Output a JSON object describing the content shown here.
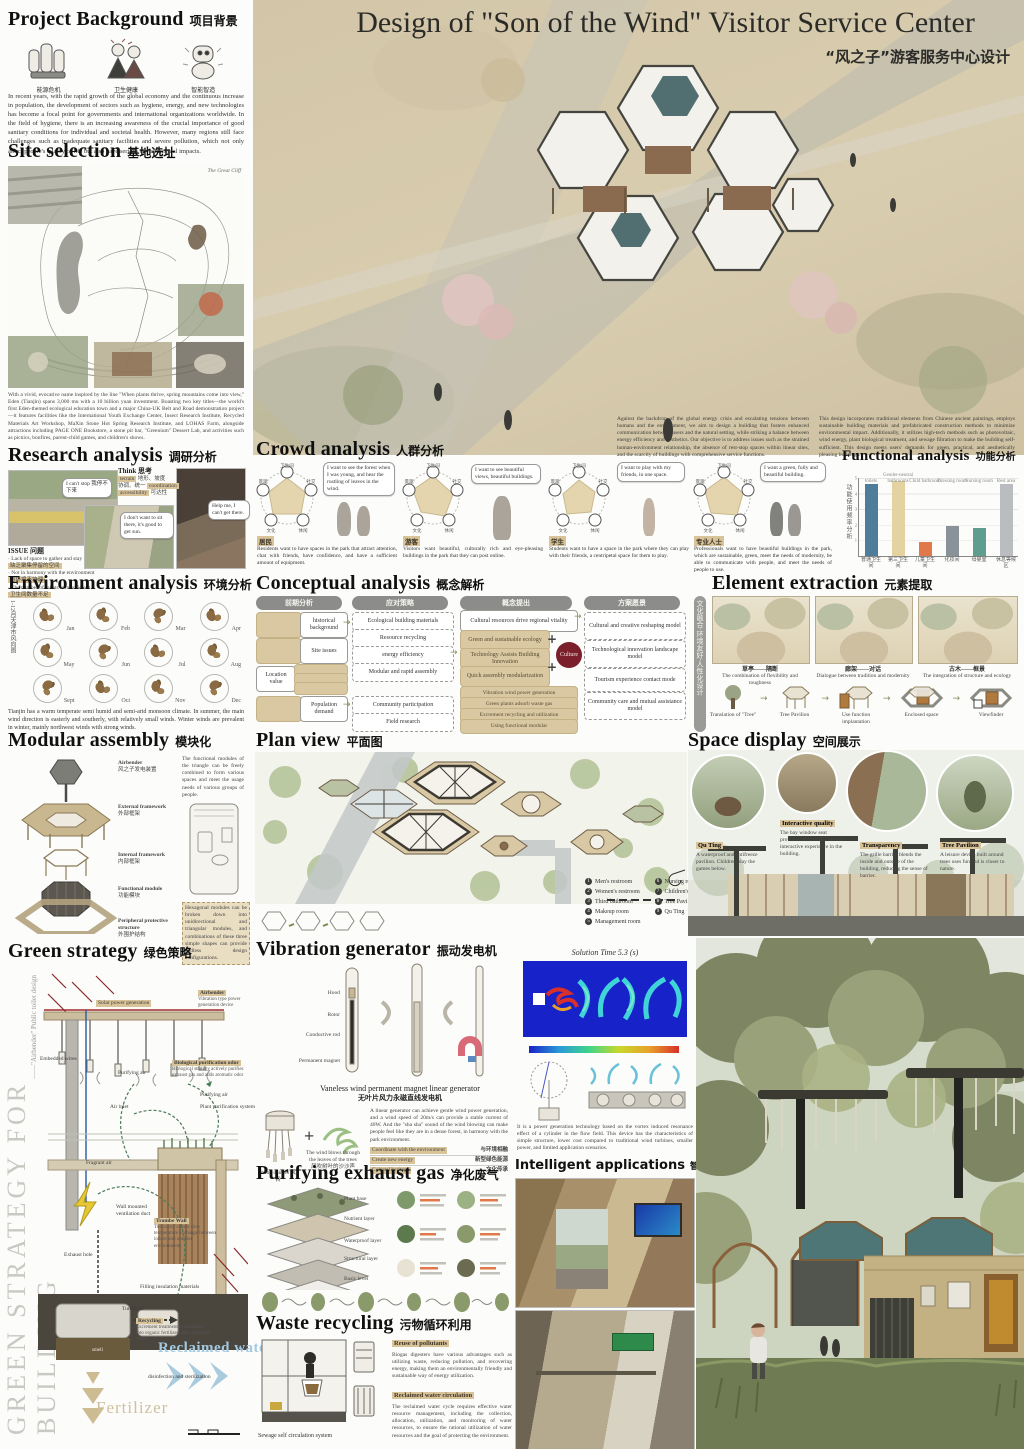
{
  "ui": {
    "plus": "+",
    "arrow": "→",
    "think_arrow": "➤"
  },
  "poster": {
    "title_en": "Design of \"Son of the Wind\" Visitor Service Center",
    "title_zh": "“风之子”游客服务中心设计"
  },
  "background": {
    "h_en": "Project Background",
    "h_zh": "项目背景",
    "icons": [
      {
        "label": "能源危机"
      },
      {
        "label": "卫生健康"
      },
      {
        "label": "智能智造"
      }
    ],
    "body": "In recent years, with the rapid growth of the global economy and the continuous increase in population, the development of sectors such as hygiene, energy, and new technologies has become a focal point for governments and international organizations worldwide. In the field of hygiene, there is an increasing awareness of the crucial importance of good sanitary conditions for individual and societal health. However, many regions still face challenges such as inadequate sanitary facilities and severe pollution, which not only affect people's quality of life but also have serious environmental impacts."
  },
  "site": {
    "h_en": "Site selection",
    "h_zh": "基地选址",
    "map_label": "The Great Cliff",
    "body": "With a vivid, evocative name inspired by the line \"When plants thrive, spring mountains come into view,\" Eden (Tianjin) spans 3,000 mu with a 10 billion yuan investment. Boasting two key titles—the world's first Eden-themed ecological education town and a major China-UK Belt and Road demonstration project—it features facilities like the International Youth Exchange Center, Insect Research Institute, Recycled Materials Art Workshop, MaXin Stone Hot Spring Research Institute, and LOHAS Farm, alongside attractions including PAGE ONE Bookstore, a stone pit bar, \"Greenium\" Dessert Lab, and activities such as picnics, bonfires, parent-child games, and children's shows."
  },
  "hero": {
    "caption_left": "Against the backdrop of the global energy crisis and escalating tensions between humans and the environment, we aim to design a building that fosters enhanced communication between users and the natural setting, while striking a balance between energy efficiency and aesthetics. Our objective is to address issues such as the strained human-environment relationship, the absence of rest-stop spaces within linear sites, and the scarcity of buildings with comprehensive service functions.",
    "caption_right": "This design incorporates traditional elements from Chinese ancient paintings, employs sustainable building materials and prefabricated construction methods to minimize environmental impact. Additionally, it utilizes high-tech methods such as photovoltaic, wind energy, plant biological treatment, and sewage filtration to make the building self-sufficient. This design meets users' demands for green, practical, and aesthetically pleasing buildings."
  },
  "research": {
    "h_en": "Research analysis",
    "h_zh": "调研分析",
    "think_label": "Think 思考",
    "keywords": [
      {
        "en": "terrain",
        "zh": "地形、坡度"
      },
      {
        "en": "coordination",
        "zh": "协调、统一"
      },
      {
        "en": "accessibility",
        "zh": "可达性"
      }
    ],
    "bubbles": [
      "I can't stop 我停不下来",
      "I don't want to sit there, it's good to get sun.",
      "Help me, I can't get there."
    ],
    "issue_label": "ISSUE 问题",
    "issues": [
      {
        "en": "Lack of space to gather and stay",
        "zh": "缺乏聚集停留的空间"
      },
      {
        "en": "Not in harmony with the environment",
        "zh": "与环境不协调"
      },
      {
        "en": "The number of toilets is insufficient",
        "zh": "卫生间数量不足"
      }
    ]
  },
  "environment": {
    "h_en": "Environment analysis",
    "h_zh": "环境分析",
    "side_label": "1-12月天津市风向图",
    "months": [
      "Jan",
      "Feb",
      "Mar",
      "Apr",
      "May",
      "Jun",
      "Jul",
      "Aug",
      "Sept",
      "Oct",
      "Nov",
      "Dec"
    ],
    "body": "Tianjin has a warm temperate semi humid and semi-arid monsoon climate. In summer, the main wind direction is easterly and southerly, with relatively small winds. Winter winds are prevalent in winter, mainly northwest winds with strong winds."
  },
  "crowd": {
    "h_en": "Crowd analysis",
    "h_zh": "人群分析",
    "radar_nodes": [
      "卫生间",
      "社交",
      "休闲",
      "文化",
      "景观"
    ],
    "personas": [
      {
        "tag": "居民",
        "quote": "I want to see the forest when I was young, and hear the rustling of leaves in the wind.",
        "desc": "Residents want to have spaces in the park that attract attention, chat with friends, have confidence, and have a sufficient amount of equipment."
      },
      {
        "tag": "游客",
        "quote": "I want to see beautiful views, beautiful buildings.",
        "desc": "Visitors want beautiful, culturally rich and eye-pleasing buildings in the park that they can post online."
      },
      {
        "tag": "学生",
        "quote": "I want to play with my friends, in one space.",
        "desc": "Students want to have a space in the park where they can play with their friends, a centripetal space for them to play."
      },
      {
        "tag": "专业人士",
        "quote": "I want a green, fully and beautiful building.",
        "desc": "Professionals want to have beautiful buildings in the park, which are sustainable, green, meet the needs of modernity, be able to communicate with people, and meet the needs of people to use."
      }
    ]
  },
  "functional": {
    "h_en": "Functional analysis",
    "h_zh": "功能分析",
    "axis_label": "功能使用频率分析",
    "chart_data": {
      "type": "bar",
      "categories": [
        "普通卫生间",
        "第三卫生间",
        "儿童卫生间",
        "化妆间",
        "母婴室",
        "休息等候区"
      ],
      "top_labels": [
        "toilets",
        "Gender-neutral bathrooms",
        "Child bathroom",
        "Dressing room",
        "Nursing room",
        "Rest area"
      ],
      "values": [
        4.6,
        4.8,
        0.9,
        1.9,
        1.8,
        4.6
      ],
      "colors": [
        "#4e7d99",
        "#e4d3a0",
        "#e0784a",
        "#8a9299",
        "#5f9e8f",
        "#b9bdbf"
      ],
      "ylim": [
        0,
        5
      ],
      "ylabel": "功能使用频率分析"
    }
  },
  "conceptual": {
    "h_en": "Conceptual analysis",
    "h_zh": "概念解析",
    "col_headers": [
      "前期分析",
      "应对策略",
      "概念提出",
      "方案愿景"
    ],
    "col1": [
      "historical background",
      "Site issues",
      "Location value",
      "Population demand"
    ],
    "col2": [
      "Ecological building materials",
      "Resource recycling",
      "energy efficiency",
      "Modular and rapid assembly",
      "Community participation",
      "Field research"
    ],
    "col3_top": "Cultural resources drive regional vitality",
    "col3_core": [
      "Green and sustainable ecology",
      "Technology Assists Building Innovation",
      "Quick assembly modularization"
    ],
    "culture": "Culture",
    "col3_tan": [
      "Vibration wind power generation",
      "Green plants adsorb waste gas",
      "Excrement recycling and utilization",
      "Using functional modular"
    ],
    "col4": [
      "Cultural and creative reshaping model",
      "Technological innovation landscape model",
      "Tourism experience contact mode",
      "Community care and mutual assistance model"
    ],
    "side_label": "文化融合·环境友好·人性化设计"
  },
  "element": {
    "h_en": "Element extraction",
    "h_zh": "元素提取",
    "paintings": [
      {
        "zh": "草亭——隔断",
        "en": "The combination of flexibility and toughness"
      },
      {
        "zh": "廊架——对话",
        "en": "Dialogue between tradition and modernity"
      },
      {
        "zh": "古木——框景",
        "en": "The integration of structure and ecology"
      }
    ],
    "steps": [
      "Translation of \"Tree\"",
      "Tree Pavilion",
      "Use function implantation",
      "Enclosed space",
      "Viewfinder"
    ]
  },
  "modular": {
    "h_en": "Modular assembly",
    "h_zh": "模块化",
    "labels": [
      {
        "en": "Airbender",
        "zh": "风之子发电装置"
      },
      {
        "en": "External framework",
        "zh": "外部框架"
      },
      {
        "en": "Internal framework",
        "zh": "内部框架"
      },
      {
        "en": "Functional module",
        "zh": "功能模块"
      },
      {
        "en": "Peripheral protective structure",
        "zh": "外围护结构"
      }
    ],
    "note1": "The functional modules of the triangle can be freely combined to form various spaces and meet the usage needs of various groups of people.",
    "note2": "Hexagonal modules can be broken down into unidirectional and triangular modules, and combinations of these three simple shapes can provide endless design configurations."
  },
  "plan": {
    "h_en": "Plan view",
    "h_zh": "平面图",
    "legend": [
      {
        "n": "1",
        "label": "Men's restroom"
      },
      {
        "n": "2",
        "label": "Women's restroom"
      },
      {
        "n": "3",
        "label": "Third bathroom"
      },
      {
        "n": "4",
        "label": "Makeup room"
      },
      {
        "n": "5",
        "label": "Management room"
      },
      {
        "n": "6",
        "label": "Nursing room"
      },
      {
        "n": "7",
        "label": "Children's restroom"
      },
      {
        "n": "8",
        "label": "Tree Pavilion"
      },
      {
        "n": "9",
        "label": "Qu Ting"
      }
    ]
  },
  "space": {
    "h_en": "Space display",
    "h_zh": "空间展示",
    "callouts": [
      {
        "title": "Qu Ting",
        "body": "A waterproof and antifreeze pavilion. Children play the games below."
      },
      {
        "title": "Interactive quality",
        "body": "The bay window seat provides users with a diverse interactive experience in the building."
      },
      {
        "title": "Transparency",
        "body": "The grille barrier blends the inside and outside of the building, reducing the sense of barrier."
      },
      {
        "title": "Tree Pavilion",
        "body": "A leisure device built around trees uses fun and is closer to nature."
      }
    ]
  },
  "green": {
    "h_en": "Green strategy",
    "h_zh": "绿色策略",
    "side_big": "GREEN STRATEGY FOR BUILDING",
    "side_small": "——\"Airbender\" Public toilet design",
    "labels": {
      "solar": "Solar power generation",
      "airbender_t": "Airbender",
      "airbender_d": "Vibration type power generation device",
      "wires": "Embedded wires",
      "pur_air1": "Purifying air",
      "bio_t": "Biological purification odor",
      "bio_d": "Biological strategy actively purifies exhaust gas and adds aromatic odor",
      "pur_air2": "Purifying air",
      "plant_sys": "Plant purification system",
      "air_inlet": "Air inlet",
      "fragrant": "Fragrant air",
      "duct": "Wall mounted ventilation duct",
      "trombe_t": "Trombe Wall",
      "trombe_d": "The cavity causes slow temperature exchange between indoor and outdoor environments",
      "fill": "Filling insulation materials",
      "turbid": "Turbid air",
      "exhaust": "Exhaust hole",
      "recycling_t": "Recycling",
      "recycling_d": "Excrement treatment is converted into organic fertilizers and reclaimed water",
      "disinfect": "disinfection and sterilization",
      "reclaimed": "Reclaimed water",
      "fertilizer": "Fertilizer",
      "smell": "smell"
    }
  },
  "vibration": {
    "h_en": "Vibration generator",
    "h_zh": "振动发电机",
    "parts": [
      "Hood",
      "Rotor",
      "Conductive rod",
      "Permanent magnet"
    ],
    "caption_en": "Vaneless wind permanent magnet linear generator",
    "caption_zh": "无叶片风力永磁直线发电机",
    "chimes_en": "Wind chimes",
    "chimes_zh": "风铃",
    "leaves_en": "The wind blows through the leaves of the trees",
    "leaves_zh": "风吹树叶的沙沙声",
    "para": "A linear generator can achieve gentle wind power generation, and a wind speed of 20m/s can provide a stable current of 40W. And the \"sha sha\" sound of the wind blowing can make people feel like they are in a dense forest, in harmony with the park environment.",
    "highlights": [
      {
        "en": "Coordinate with the environment",
        "zh": "与环境相融"
      },
      {
        "en": "Create new energy",
        "zh": "新型绿色能源"
      },
      {
        "en": "Cultural heritage",
        "zh": "文化传承"
      }
    ]
  },
  "cfd": {
    "title": "Solution Time 5.3 (s)",
    "para": "It is a power generation technology based on the vortex induced resonance effect of a cylinder in the flow field. This device has the characteristics of simple structure, lower cost compared to traditional wind turbines, smaller power, and limited application scenarios."
  },
  "purify": {
    "h_en": "Purifying exhaust gas",
    "h_zh": "净化废气",
    "layers": [
      "Plant base",
      "Nutrient layer",
      "Waterproof layer",
      "Structural layer",
      "Basic level"
    ]
  },
  "intelligent": {
    "h_en": "Intelligent applications",
    "h_zh": "智能化应用"
  },
  "waste": {
    "h_en": "Waste recycling",
    "h_zh": "污物循环利用",
    "diagram_label": "Sewage self circulation system",
    "blocks": [
      {
        "title": "Reuse of pollutants",
        "body": "Biogas digesters have various advantages such as utilizing waste, reducing pollution, and recovering energy, making them an environmentally friendly and sustainable way of energy utilization."
      },
      {
        "title": "Reclaimed water circulation",
        "body": "The reclaimed water cycle requires effective water resource management, including the collection, allocation, utilization, and monitoring of water resources, to ensure the rational utilization of water resources and the goal of protecting the environment."
      }
    ]
  }
}
